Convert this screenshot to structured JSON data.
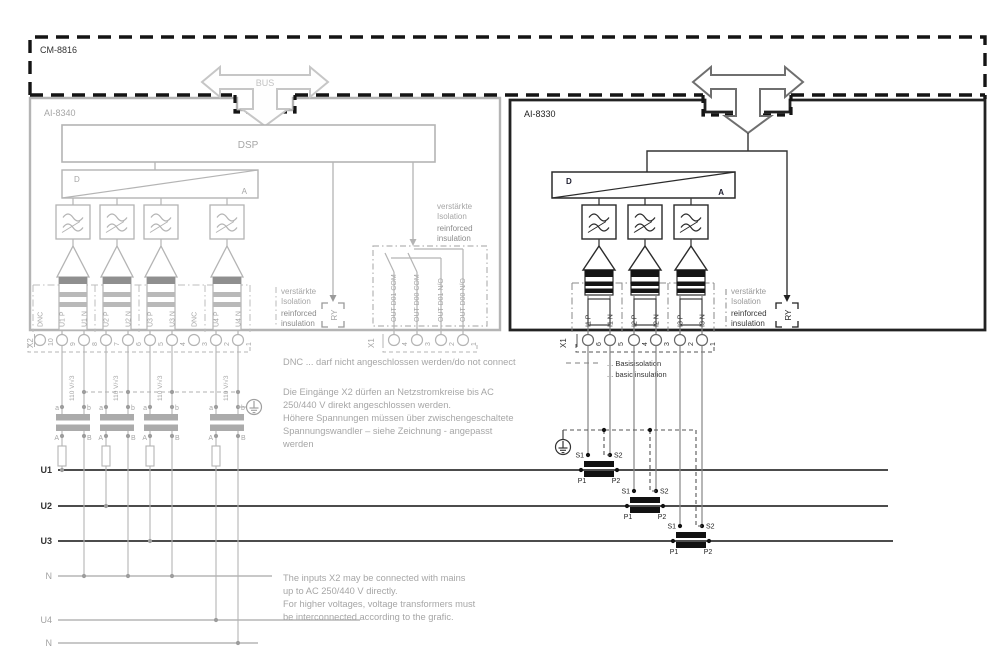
{
  "frame": {
    "label": "CM-8816",
    "bus_label": "BUS"
  },
  "left_module": {
    "label": "AI-8340",
    "dsp_label": "DSP",
    "dac": {
      "d": "D",
      "a": "A"
    },
    "relay_label": "RY",
    "insulation_note": {
      "de": [
        "verstärkte",
        "Isolation"
      ],
      "en": [
        "reinforced",
        "insulation"
      ]
    },
    "relay_outputs": [
      "OUT D01 COM",
      "OUT D00 COM",
      "OUT D01 N/O",
      "OUT D00 N/O"
    ],
    "terminal_x2": {
      "label": "X2",
      "numbers": [
        "10",
        "9",
        "8",
        "7",
        "6",
        "5",
        "4",
        "3",
        "2",
        "1"
      ],
      "signals": [
        "DNC",
        "U1 P",
        "U1 N",
        "U2 P",
        "U2 N",
        "U3 P",
        "U3 N",
        "DNC",
        "U4 P",
        "U4 N"
      ]
    },
    "terminal_x1": {
      "label": "X1",
      "numbers": [
        "4",
        "3",
        "2",
        "1"
      ]
    }
  },
  "right_module": {
    "label": "AI-8330",
    "dac": {
      "d": "D",
      "a": "A"
    },
    "relay_label": "RY",
    "insulation_note": {
      "de": [
        "verstärkte",
        "Isolation"
      ],
      "en": [
        "reinforced",
        "insulation"
      ]
    },
    "terminal_x1": {
      "label": "X1",
      "numbers": [
        "6",
        "5",
        "4",
        "3",
        "2",
        "1"
      ],
      "signals": [
        "I1 P",
        "I1 N",
        "I2 P",
        "I2 N",
        "I3 P",
        "I3 N"
      ]
    }
  },
  "voltage_transformers": {
    "rating": "110 V/√3",
    "secondary_terminals": [
      "a",
      "b"
    ],
    "primary_terminals": [
      "A",
      "B"
    ]
  },
  "current_transformers": {
    "secondary_terminals": [
      "S1",
      "S2"
    ],
    "primary_terminals": [
      "P1",
      "P2"
    ]
  },
  "power_lines": [
    {
      "label": "U1",
      "emphasis": true
    },
    {
      "label": "U2",
      "emphasis": true
    },
    {
      "label": "U3",
      "emphasis": true
    },
    {
      "label": "N",
      "emphasis": false
    },
    {
      "label": "U4",
      "emphasis": false
    },
    {
      "label": "N",
      "emphasis": false
    }
  ],
  "legend": {
    "dashed_de": "... Basisisolation",
    "dashed_en": "... basic insulation"
  },
  "notes": {
    "dnc": "DNC ... darf nicht angeschlossen werden/do not connect",
    "german": [
      "Die Eingänge X2 dürfen an Netzstromkreise bis AC",
      "250/440 V direkt angeschlossen werden.",
      "Höhere Spannungen müssen über zwischengeschaltete",
      "Spannungswandler – siehe Zeichnung - angepasst",
      "werden"
    ],
    "english": [
      "The inputs X2 may be connected with mains",
      "up to AC 250/440 V directly.",
      "For higher voltages, voltage transformers must",
      "be interconnected according to the grafic."
    ]
  },
  "colors": {
    "frame_border": "#141414",
    "left_module": "#b4b4b4",
    "right_module": "#222222",
    "power_line": "#4c4c4c",
    "neutral_line": "#a2a2a2",
    "gray_text": "#a6a6a6",
    "dark_text": "#333333"
  }
}
